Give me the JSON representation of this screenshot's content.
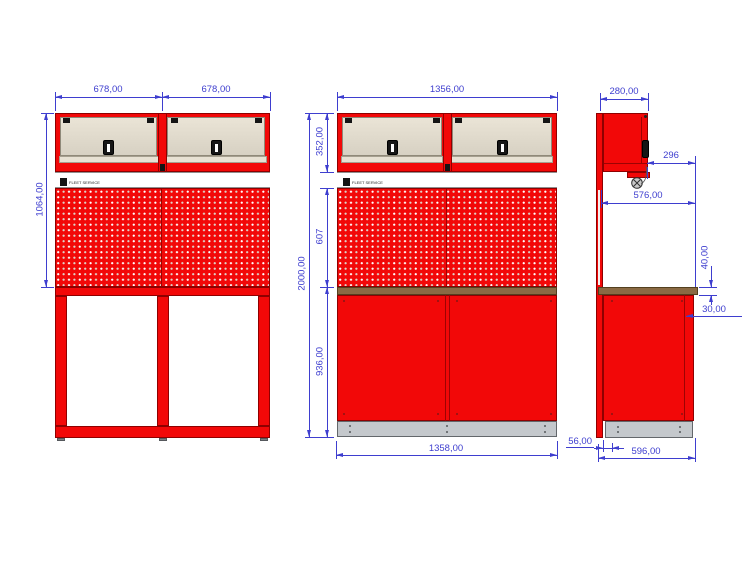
{
  "colors": {
    "red": "#f20808",
    "red_dark": "#8f0000",
    "line_dark": "#9c0303",
    "beige_border": "#8f8979",
    "worktop": "#8a6a44",
    "worktop_border": "#53401f",
    "plinth": "#c4c8cc",
    "plinth_border": "#63676b",
    "white_strip_border": "#909090",
    "dim": "#3e3ecf"
  },
  "brand": {
    "logo_text": "FLEET SERVICE"
  },
  "dims": {
    "front_modules_width_left": "678,00",
    "front_modules_width_right": "678,00",
    "front_modules_upper_height": "1064,00",
    "assembly_width": "1356,00",
    "assembly_cabinet_height": "352,00",
    "assembly_total_height": "2000,00",
    "assembly_pegboard_height": "607",
    "assembly_base_height": "936,00",
    "assembly_base_width": "1358,00",
    "side_cabinet_depth": "280,00",
    "side_hook_offset": "296",
    "side_clear_depth": "576,00",
    "side_worktop_thickness": "40,00",
    "side_worktop_overhang": "30,00",
    "side_rail_offset": "56,00",
    "side_total_depth": "596,00"
  }
}
